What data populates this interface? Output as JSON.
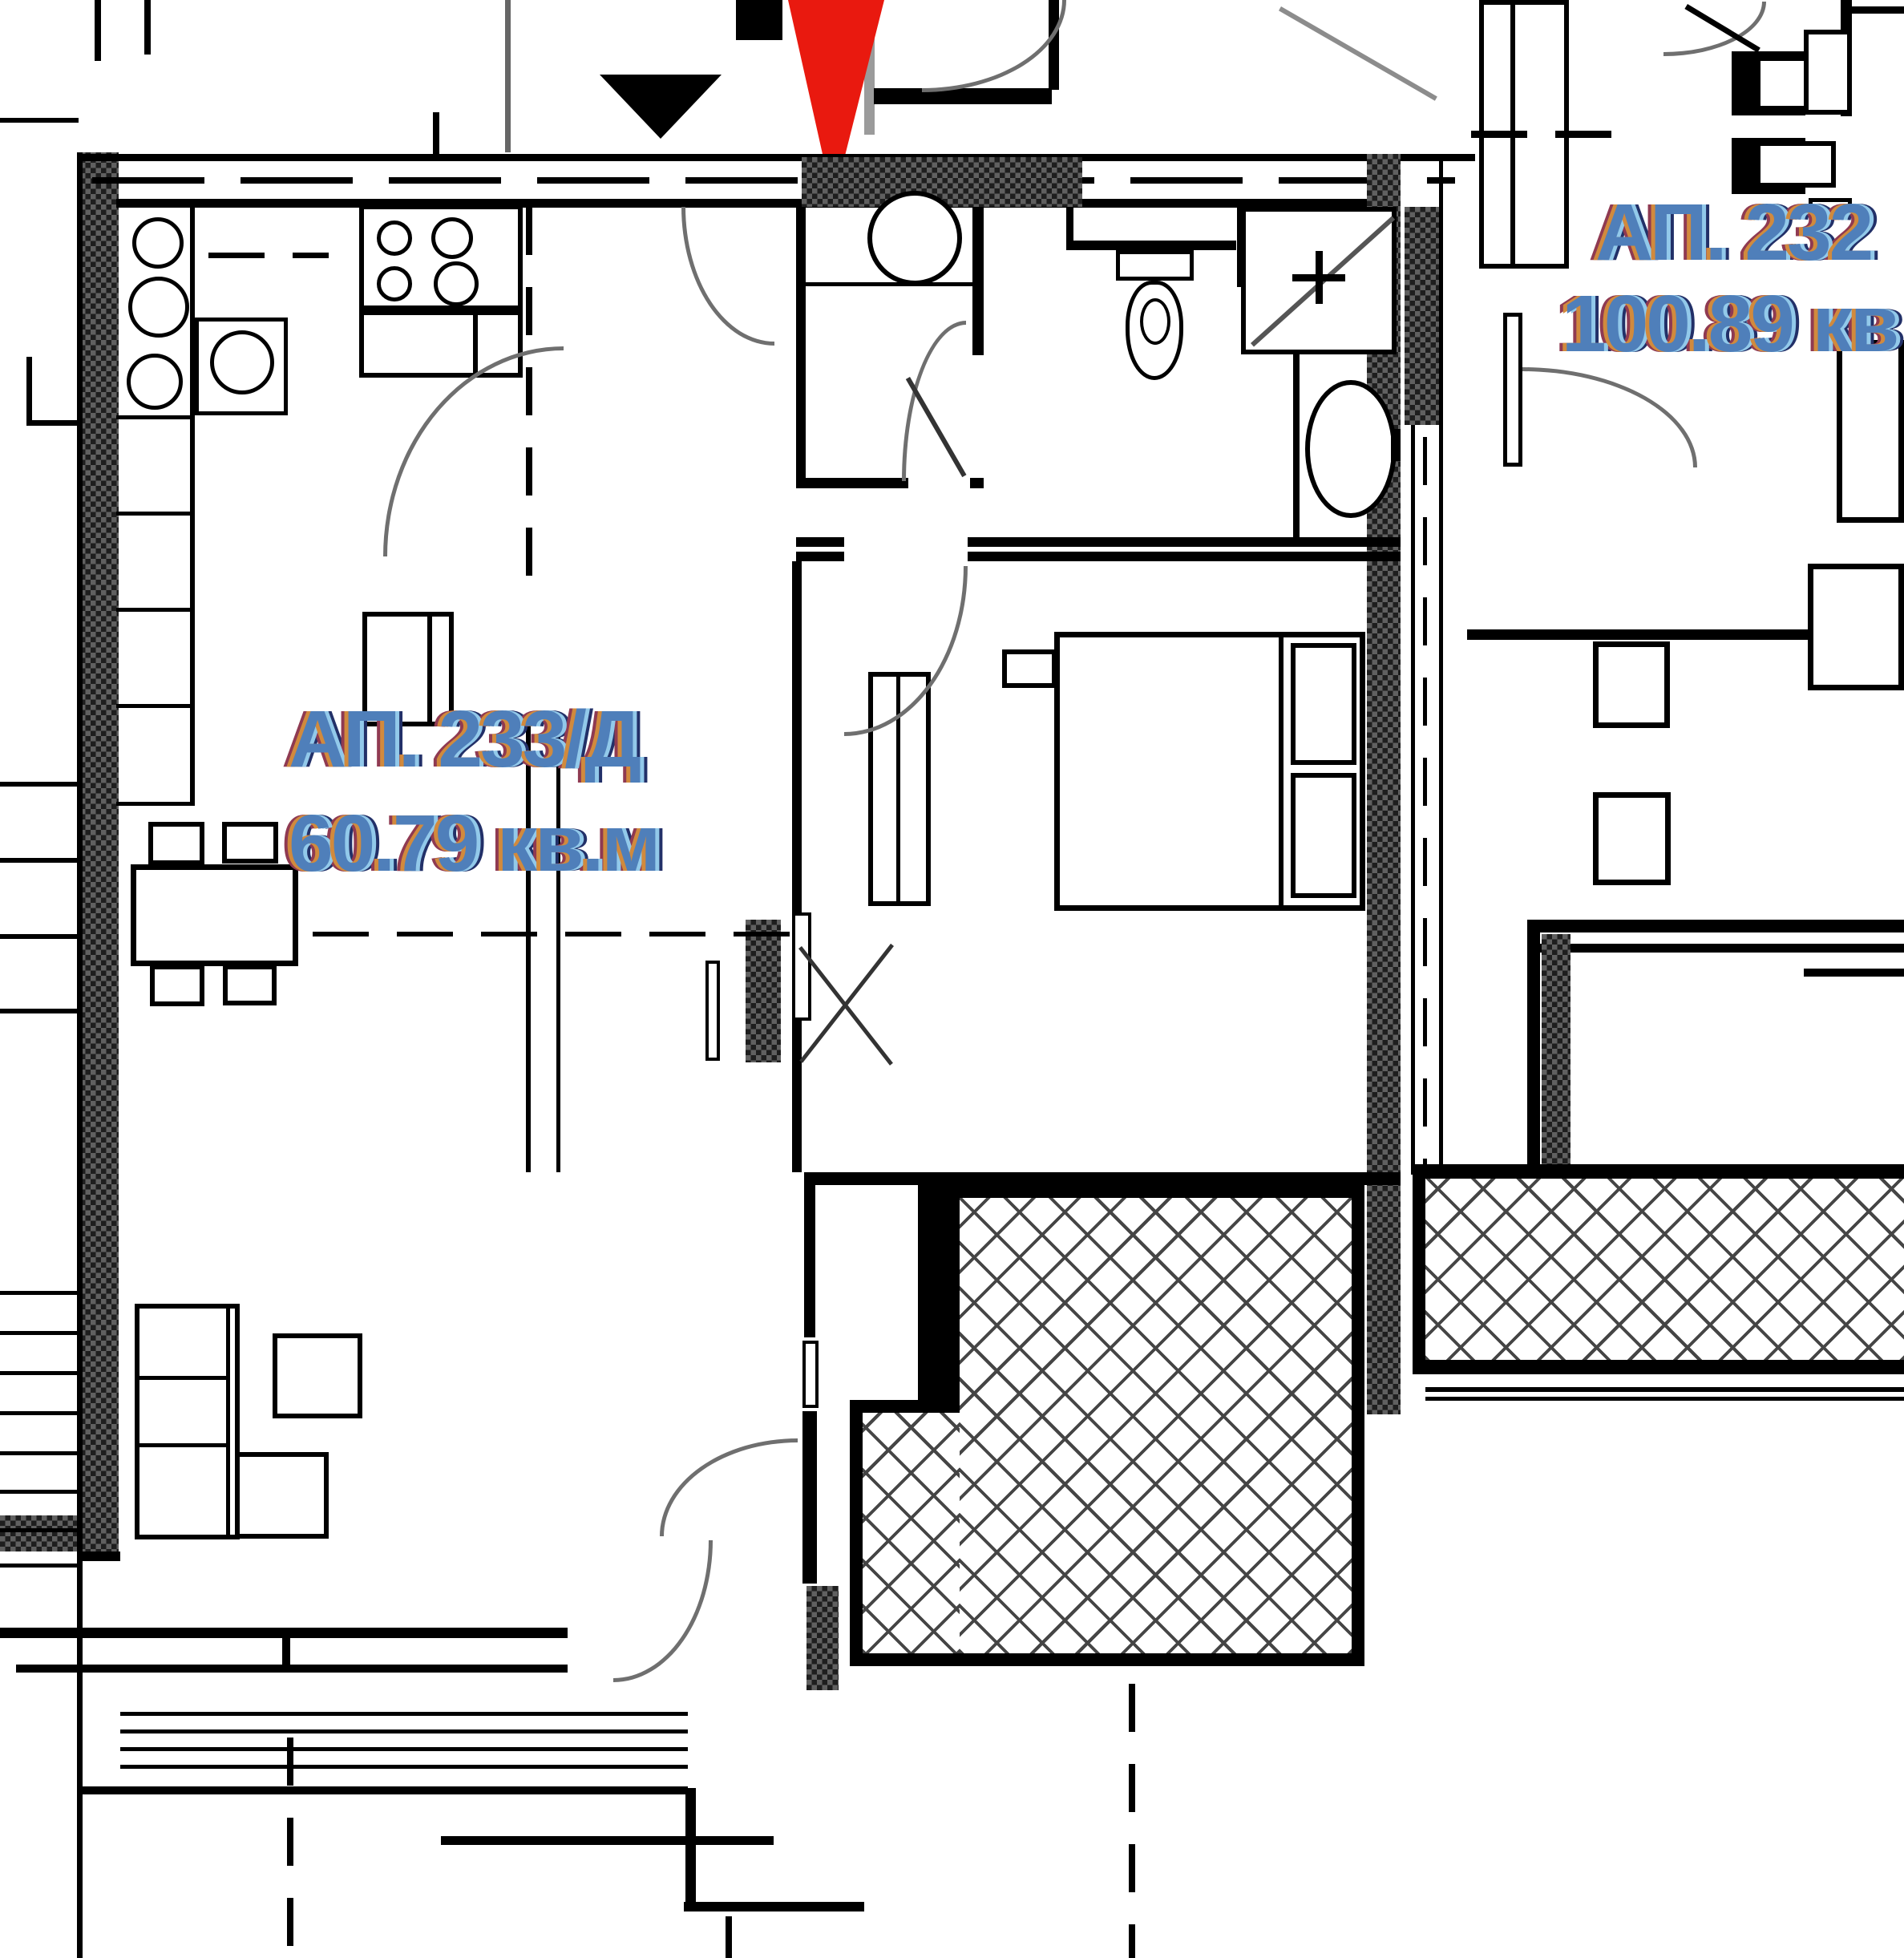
{
  "labels": {
    "unit_left": {
      "id": "АП. 233/Д",
      "area": "60.79 кв.м"
    },
    "unit_right": {
      "id": "АП. 232",
      "area": "100.89 кв"
    }
  },
  "colors": {
    "marker_red": "#e9190f",
    "wall_black": "#000000",
    "arc_gray": "#6f6f6f",
    "stem_gray": "#9b9b9b",
    "hatch_dark": "#1e1e1e",
    "hatch_mid": "#606060",
    "lattice_gray": "#454545",
    "text_base": "#4f7fba",
    "text_orange": "#d18a3d",
    "text_lightblue": "#92c9ea",
    "text_navy": "#223068",
    "text_maroon": "#8f3a52"
  },
  "icons": {
    "marker": "red-location-arrow-icon",
    "orientation": "black-triangle-down-icon"
  }
}
